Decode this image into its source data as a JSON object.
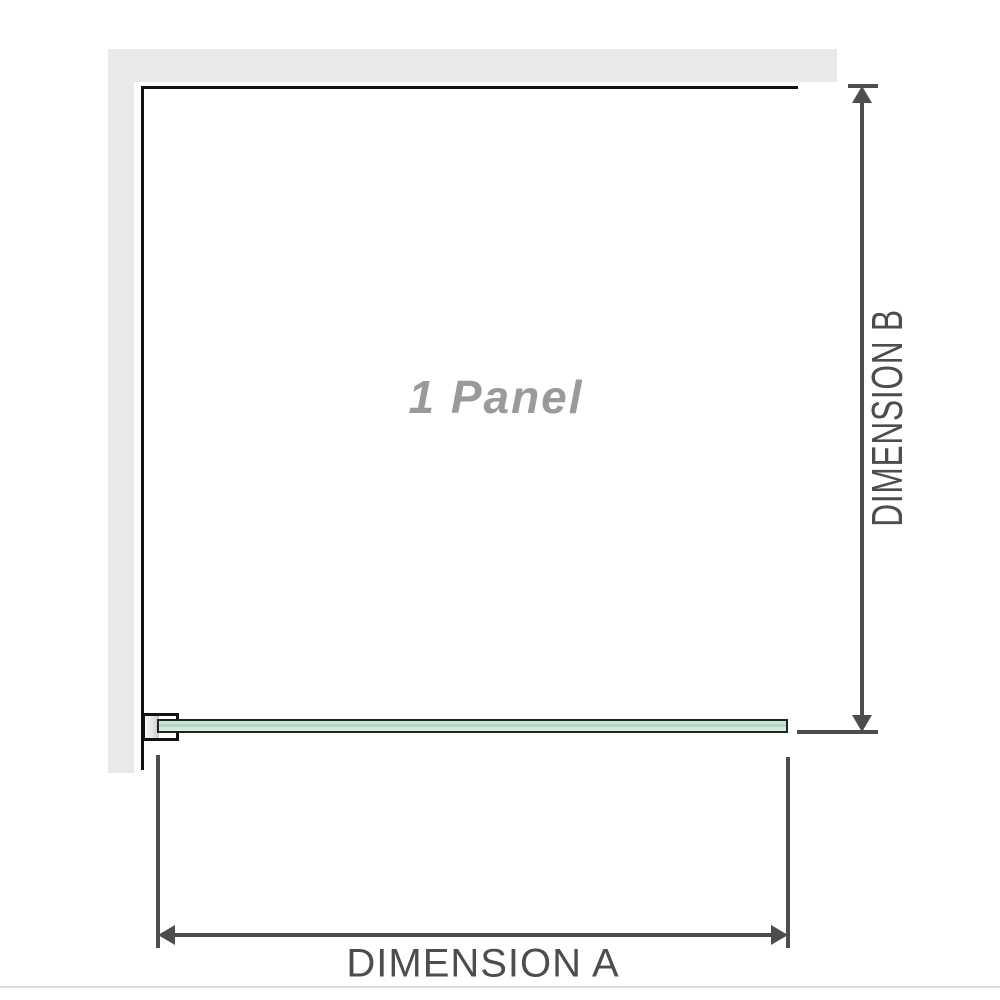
{
  "diagram": {
    "panel_label": "1 Panel",
    "dimension_a_label": "DIMENSION A",
    "dimension_b_label": "DIMENSION B",
    "colors": {
      "wall_fill": "#e9e9e9",
      "panel_edge": "#131313",
      "glass_fill_light": "#cbe8d9",
      "glass_fill_stripe": "#9ed2ba",
      "glass_edge": "#222222",
      "dimension_line": "#4d4d4d",
      "dimension_text": "#4d4d4d",
      "panel_label_text": "#9a9a9a",
      "separator": "#dcdcdc",
      "background": "#ffffff"
    }
  }
}
